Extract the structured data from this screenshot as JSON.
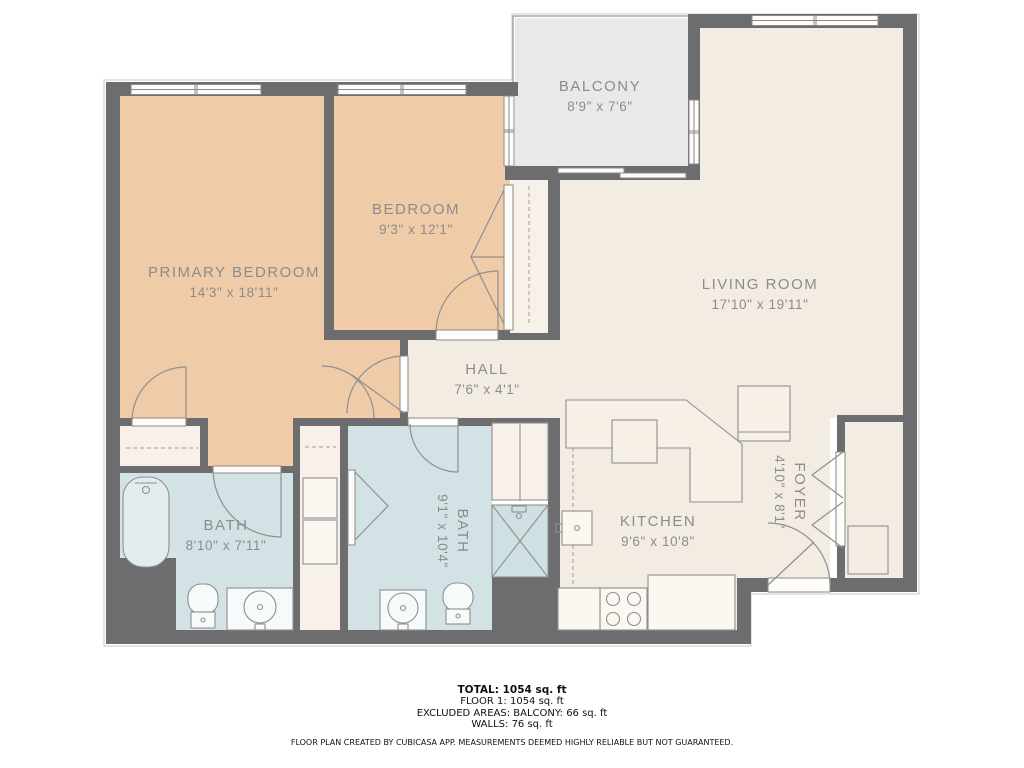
{
  "title": "Floor plan",
  "rooms": {
    "primary_bedroom": {
      "name": "PRIMARY BEDROOM",
      "dims": "14'3\" x 18'11\""
    },
    "bedroom": {
      "name": "BEDROOM",
      "dims": "9'3\" x 12'1\""
    },
    "balcony": {
      "name": "BALCONY",
      "dims": "8'9\" x 7'6\""
    },
    "living_room": {
      "name": "LIVING ROOM",
      "dims": "17'10\" x 19'11\""
    },
    "hall": {
      "name": "HALL",
      "dims": "7'6\" x 4'1\""
    },
    "bath1": {
      "name": "BATH",
      "dims": "8'10\" x 7'11\""
    },
    "bath2": {
      "name": "BATH",
      "dims": "9'1\" x 10'4\""
    },
    "kitchen": {
      "name": "KITCHEN",
      "dims": "9'6\" x 10'8\""
    },
    "foyer": {
      "name": "FOYER",
      "dims": "4'10\" x 8'1\""
    }
  },
  "footer": {
    "total": "TOTAL: 1054 sq. ft",
    "floor": "FLOOR 1: 1054 sq. ft",
    "excluded": "EXCLUDED AREAS: BALCONY: 66 sq. ft",
    "walls": "WALLS: 76 sq. ft",
    "disclaimer": "FLOOR PLAN CREATED BY CUBICASA APP. MEASUREMENTS DEEMED HIGHLY RELIABLE BUT NOT GUARANTEED."
  },
  "colors": {
    "wall": "#6d6d70",
    "bedroom_floor": "#f0cba8",
    "main_floor": "#f3ece2",
    "closet_floor": "#f7f1e9",
    "bath_floor": "#d3e3e5",
    "balcony_floor": "#e9e9eb",
    "label_text": "#8c8c8c",
    "fixture_line": "#8f8f8f"
  }
}
